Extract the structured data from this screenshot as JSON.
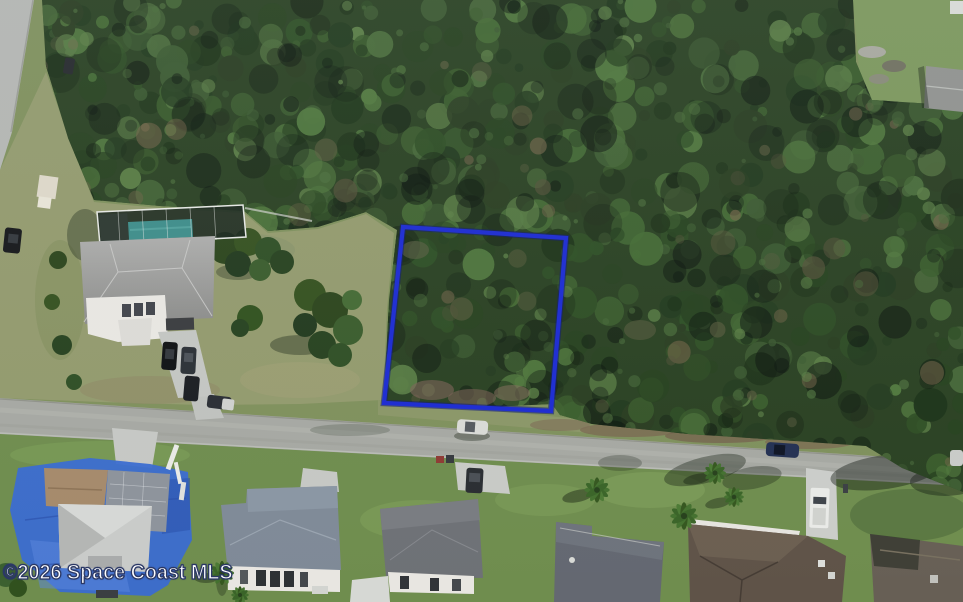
{
  "image": {
    "kind": "aerial-photograph",
    "description": "Aerial MLS listing photo of a wooded vacant residential lot outlined in blue, fronting a suburban street with single-family homes"
  },
  "watermark": {
    "text": "©2026 Space Coast MLS"
  },
  "parcel_overlay": {
    "points": "403,227 566,238 551,411 384,403",
    "stroke_color": "#1c2bd1",
    "halo_color": "#0e1a77"
  },
  "palette": {
    "canopy": [
      "#1e3419",
      "#27421f",
      "#2f4f25",
      "#3a5c2c",
      "#446a34",
      "#50773d",
      "#2a3d21",
      "#223a1e",
      "#496b3a",
      "#3c5a31",
      "#5a7d45"
    ],
    "canopy_brown": [
      "#5e5f41",
      "#6b5f45",
      "#56523a",
      "#75654a"
    ],
    "canopy_shadow": "#0b140d",
    "grass_lawn": "#6f8d4e",
    "grass_shoulder": "#7f905c",
    "clearing": "#939a6d",
    "road": "#a6a8a2",
    "pool_water": "#3e8d89",
    "tarp_blue": "#3a6bd0"
  }
}
